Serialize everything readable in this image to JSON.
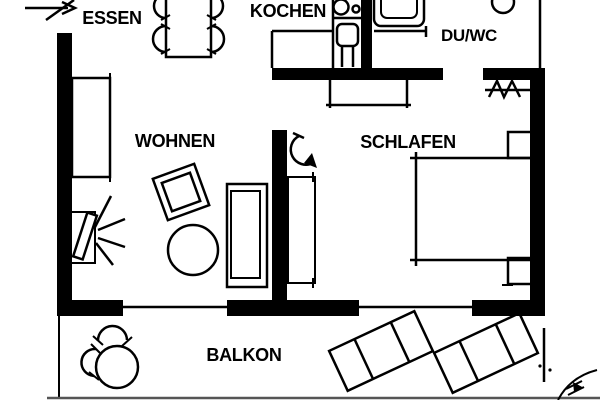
{
  "plan": {
    "rooms": {
      "essen": {
        "label": "ESSEN"
      },
      "kochen": {
        "label": "KOCHEN"
      },
      "du_wc": {
        "label": "DU/WC"
      },
      "wohnen": {
        "label": "WOHNEN"
      },
      "schlafen": {
        "label": "SCHLAFEN"
      },
      "balkon": {
        "label": "BALKON"
      }
    },
    "symbols": [
      "entrance-arrow",
      "dining-table",
      "dining-chair",
      "kitchen-unit",
      "cooktop",
      "kitchen-sink",
      "shower-tray",
      "toilet",
      "coat-hooks",
      "sideboard",
      "tv",
      "armchair",
      "coffee-table",
      "sofa",
      "door-swing",
      "wardrobe",
      "dresser",
      "bed",
      "nightstand",
      "window",
      "balcony-table",
      "balcony-chair",
      "sun-lounger",
      "shrub"
    ],
    "colors": {
      "line": "#000000",
      "background": "#ffffff"
    }
  }
}
